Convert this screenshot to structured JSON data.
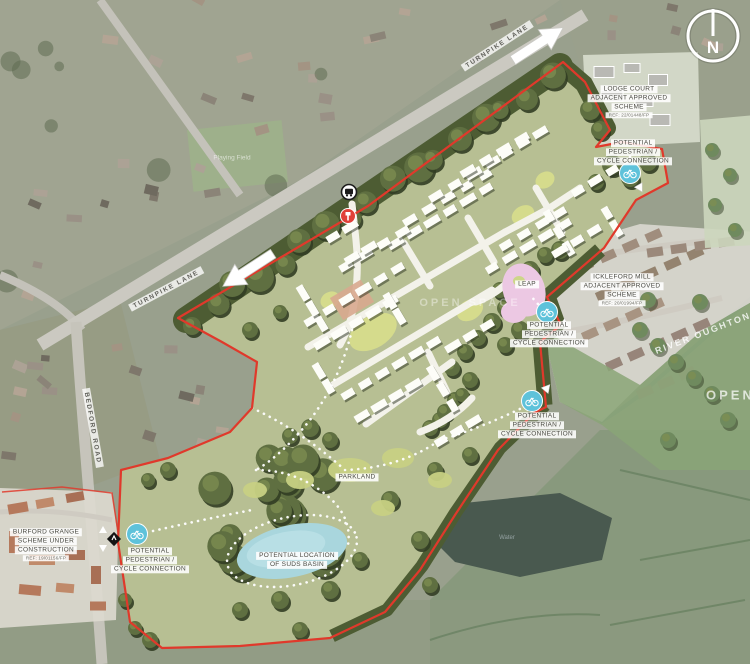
{
  "map": {
    "compass_label": "N",
    "roads": {
      "turnpike_top": "TURNPIKE LANE",
      "turnpike_west": "TURNPIKE LANE",
      "bedford": "BEDFORD ROAD"
    },
    "base": {
      "playing_field": "Playing Field",
      "water": "Water",
      "river": "RIVER OUGHTON",
      "open_space_right": "OPEN SPACE",
      "open_space_mid": "OPEN SPACE"
    },
    "schemes": {
      "lodge_court": {
        "l1": "LODGE COURT",
        "l2": "ADJACENT APPROVED",
        "l3": "SCHEME",
        "ref": "REF: 22/01448/FP"
      },
      "ickleford_mill": {
        "l1": "ICKLEFORD MILL",
        "l2": "ADJACENT APPROVED",
        "l3": "SCHEME",
        "ref": "REF: 20/01994/FP"
      },
      "burford_grange": {
        "l1": "BURFORD GRANGE",
        "l2": "SCHEME UNDER",
        "l3": "CONSTRUCTION",
        "ref": "REF: 19/01156/FP"
      }
    },
    "annotations": {
      "cycle": {
        "l1": "POTENTIAL",
        "l2": "PEDESTRIAN /",
        "l3": "CYCLE CONNECTION"
      },
      "parkland": "PARKLAND",
      "suds": {
        "l1": "POTENTIAL LOCATION",
        "l2": "OF SUDS BASIN"
      },
      "leap": "LEAP"
    },
    "colors": {
      "boundary_red": "#e0392b",
      "site_green": "#b7bf93",
      "tree_green": "#5f6f41",
      "amenity_green": "#d6dc8b",
      "suds_blue": "#a9d6dd",
      "leap_pink": "#ecc8e3",
      "cycle_icon_blue": "#5ec2da",
      "marker_red": "#e04038"
    }
  }
}
